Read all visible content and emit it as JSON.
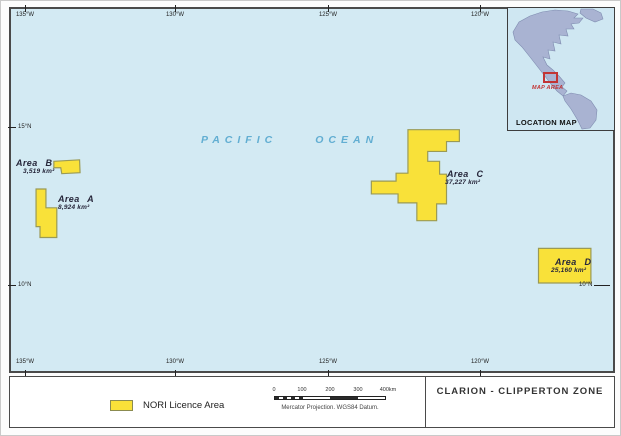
{
  "map": {
    "ocean_words": [
      "PACIFIC",
      "OCEAN"
    ],
    "ticks_top": [
      "135°W",
      "130°W",
      "125°W",
      "120°W"
    ],
    "ticks_bottom": [
      "135°W",
      "130°W",
      "125°W",
      "120°W"
    ],
    "ticks_left": [
      "15°N",
      "10°N"
    ],
    "ticks_right": [
      "10°N"
    ],
    "areas": [
      {
        "name": "Area B",
        "size": "3,519 km²"
      },
      {
        "name": "Area A",
        "size": "8,924 km²"
      },
      {
        "name": "Area C",
        "size": "37,227 km²"
      },
      {
        "name": "Area D",
        "size": "25,160 km²"
      }
    ]
  },
  "inset": {
    "title": "LOCATION MAP",
    "map_area": "MAP AREA"
  },
  "legend": {
    "item": "NORI Licence Area"
  },
  "scalebar": {
    "ticks": [
      "0",
      "100",
      "200",
      "300",
      "400km"
    ],
    "caption": "Mercator Projection. WGS84 Datum."
  },
  "titlebox": {
    "text": "CLARION - CLIPPERTON ZONE"
  },
  "colors": {
    "ocean": "#d3eaf3",
    "licence_fill": "#f9e139",
    "licence_stroke": "#9a9a55",
    "ocean_text": "#62aed2",
    "map_area_red": "#c23434",
    "continent_fill": "#a9b3d2",
    "continent_stroke": "#7f8cb0"
  }
}
